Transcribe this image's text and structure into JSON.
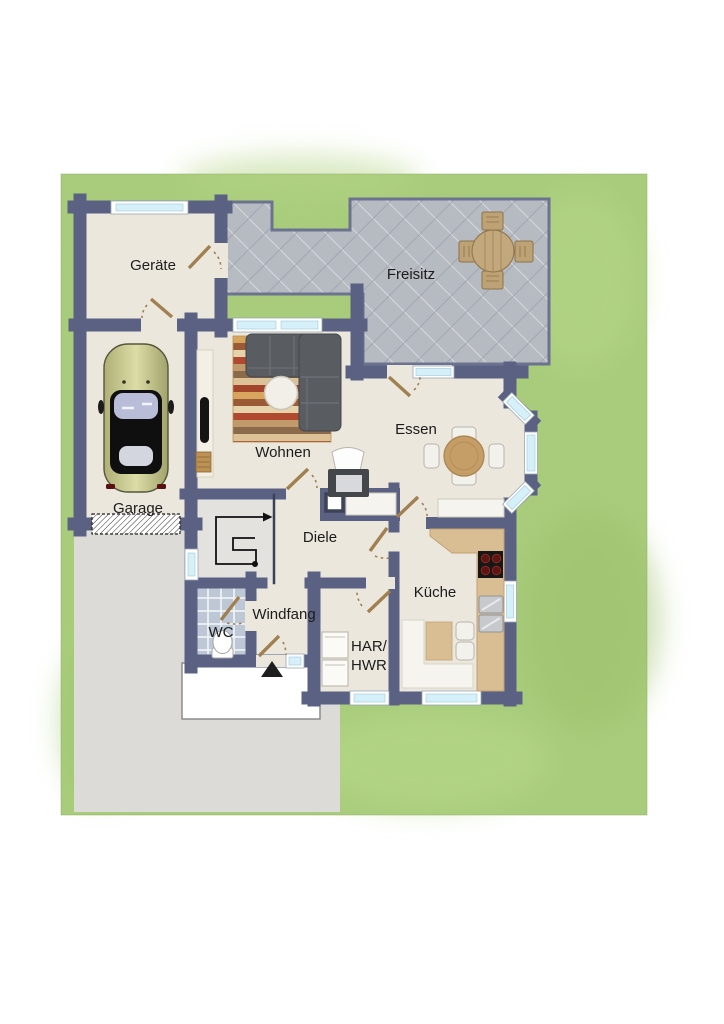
{
  "plan_title": "floor-plan-ground-floor",
  "rooms": {
    "geraete": {
      "label": "Geräte"
    },
    "freisitz": {
      "label": "Freisitz"
    },
    "garage": {
      "label": "Garage"
    },
    "wohnen": {
      "label": "Wohnen"
    },
    "essen": {
      "label": "Essen"
    },
    "diele": {
      "label": "Diele"
    },
    "windfang": {
      "label": "Windfang"
    },
    "wc": {
      "label": "WC"
    },
    "kueche": {
      "label": "Küche"
    },
    "hwr": {
      "label_line1": "HAR/",
      "label_line2": "HWR"
    }
  },
  "palette": {
    "wall": "#5a6183",
    "floor": "#ebe7dc",
    "grass": "#a8cc7b",
    "patio_tile": "#b6bac1",
    "driveway": "#dcdbd8",
    "wc_tile": "#bdc7d5",
    "window_glass": "#d6f0fa",
    "door_wood": "#a08050",
    "counter": "#d9bd93",
    "table_wood": "#c59d66",
    "patio_wood": "#bda276",
    "sofa": "#595d62",
    "car_body": "#c6c78d",
    "stair_floor": "#e4e2de",
    "porch": "#ffffff"
  }
}
